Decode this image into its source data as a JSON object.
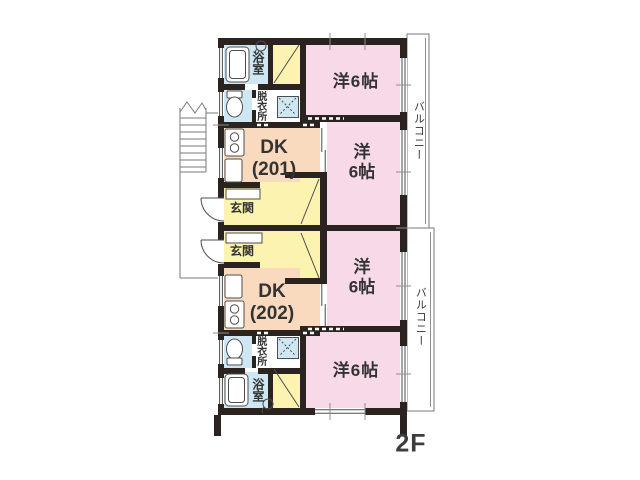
{
  "floor_plan": {
    "floor_label": "2F",
    "colors": {
      "wall": "#2a2320",
      "pink": "#f7d9e8",
      "peach": "#f9dabe",
      "yellow": "#fcf3b0",
      "blue": "#cfe6f3",
      "line": "#4d4d4d",
      "text": "#333333"
    },
    "balconies": {
      "top": "バルコニー",
      "bottom": "バルコニー"
    },
    "unit_201": {
      "dk_name": "DK",
      "dk_number": "(201)",
      "entrance": "玄関",
      "bath": "浴室",
      "dressing": "脱衣所",
      "room_top": "洋6帖",
      "room_mid_l1": "洋",
      "room_mid_l2": "6帖"
    },
    "unit_202": {
      "dk_name": "DK",
      "dk_number": "(202)",
      "entrance": "玄関",
      "bath": "浴室",
      "dressing": "脱衣所",
      "room_mid_l1": "洋",
      "room_mid_l2": "6帖",
      "room_bottom": "洋6帖"
    },
    "icons": {
      "bathtub-icon": "rounded-rect",
      "shower-hook-icon": "circle-hook",
      "toilet-icon": "oval-with-tank",
      "washing-machine-icon": "square-with-dashed-x",
      "stove-icon": "two-burner-rect",
      "sink-icon": "rounded-rect",
      "stairs-icon": "treads-with-break-line",
      "entry-door-icon": "quarter-arc",
      "closet-icon": "diagonal-line"
    }
  }
}
